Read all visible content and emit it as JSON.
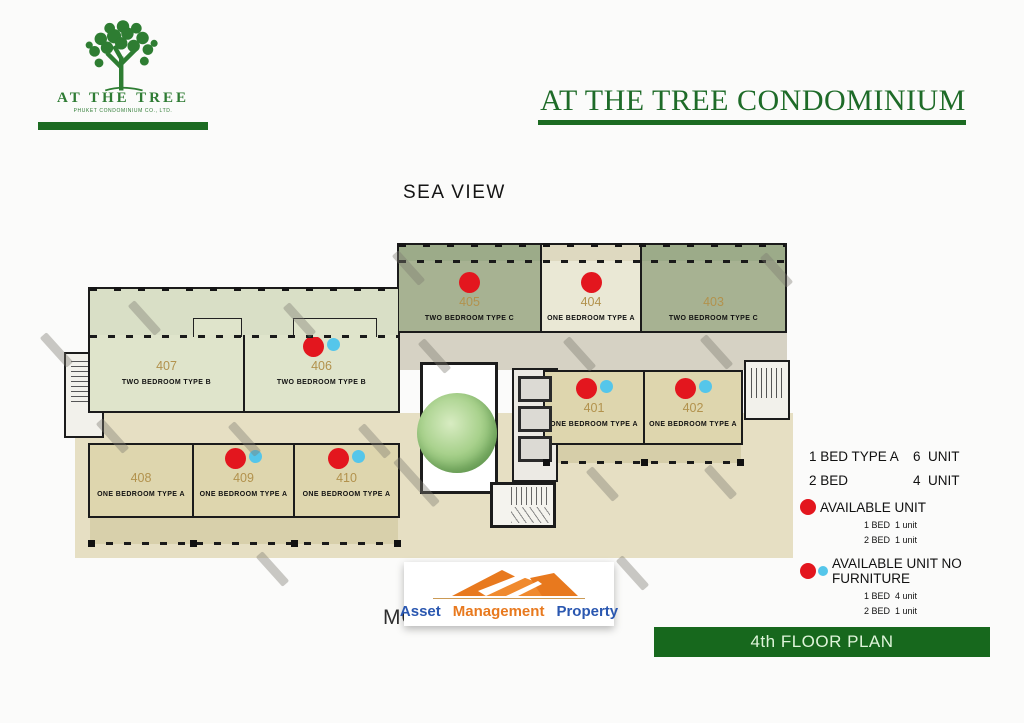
{
  "brand": {
    "logo_title": "AT THE TREE",
    "logo_subtitle": "PHUKET CONDOMINIUM CO., LTD.",
    "main_title": "AT THE TREE CONDOMINIUM"
  },
  "orientation": {
    "sea": "SEA VIEW",
    "mountain": "MOUNTAIN VIEW"
  },
  "floorplan": {
    "units": [
      {
        "number": "407",
        "type": "TWO BEDROOM TYPE B",
        "dots": []
      },
      {
        "number": "406",
        "type": "TWO BEDROOM TYPE B",
        "dots": [
          "red",
          "blue"
        ]
      },
      {
        "number": "405",
        "type": "TWO BEDROOM TYPE C",
        "dots": [
          "red"
        ]
      },
      {
        "number": "404",
        "type": "ONE BEDROOM TYPE A",
        "dots": [
          "red"
        ]
      },
      {
        "number": "403",
        "type": "TWO BEDROOM TYPE C",
        "dots": []
      },
      {
        "number": "401",
        "type": "ONE BEDROOM TYPE A",
        "dots": [
          "red",
          "blue"
        ]
      },
      {
        "number": "402",
        "type": "ONE BEDROOM TYPE A",
        "dots": [
          "red",
          "blue"
        ]
      },
      {
        "number": "408",
        "type": "ONE BEDROOM TYPE A",
        "dots": []
      },
      {
        "number": "409",
        "type": "ONE BEDROOM TYPE A",
        "dots": [
          "red",
          "blue"
        ]
      },
      {
        "number": "410",
        "type": "ONE BEDROOM TYPE A",
        "dots": [
          "red",
          "blue"
        ]
      }
    ]
  },
  "legend": {
    "summary": [
      {
        "label": "1 BED TYPE A",
        "count": "6  UNIT"
      },
      {
        "label": "2 BED",
        "count": "4  UNIT"
      }
    ],
    "available": {
      "label": "AVAILABLE UNIT",
      "rows": [
        "1 BED  1 unit",
        "2 BED  1 unit"
      ]
    },
    "no_furniture": {
      "label": "AVAILABLE UNIT NO FURNITURE",
      "rows": [
        "1 BED  4 unit",
        "2 BED  1 unit"
      ]
    },
    "total": "TOTAL 10  UNIT / FLOOR"
  },
  "footer": {
    "amp_words": [
      {
        "text": "Asset",
        "color": "#2a57b0"
      },
      {
        "text": "Management",
        "color": "#e8791e"
      },
      {
        "text": "Property",
        "color": "#2a57b0"
      }
    ],
    "banner": "4th FLOOR PLAN"
  },
  "colors": {
    "brand_green": "#1c6b22",
    "banner_green": "#17681d",
    "available_red": "#e3161e",
    "no_furniture_blue": "#55c6ea",
    "unit_number": "#b2924d",
    "type_b_fill": "#dfe4cb",
    "type_c_fill": "#a7b292",
    "one_bed_a_fill": "#ded6ae",
    "one_bed_a_cream_fill": "#eae8d5",
    "amp_orange": "#e8791e",
    "amp_blue": "#2a57b0"
  }
}
